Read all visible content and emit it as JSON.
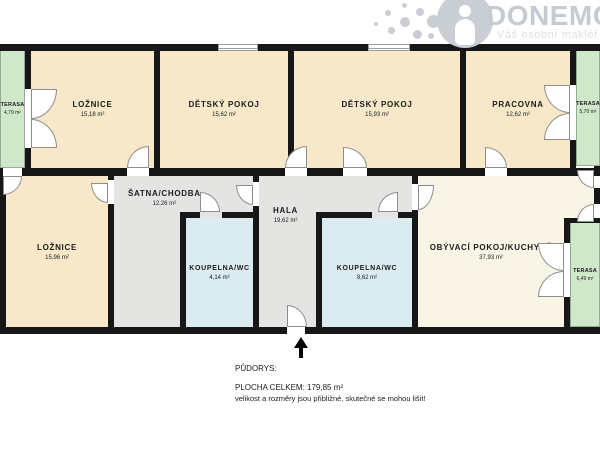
{
  "logo": {
    "brand": "DONEMO",
    "tagline": "Váš osobní makléř",
    "icon": "person-in-dotted-circle-logo",
    "color": "#c9ced4"
  },
  "rooms": [
    {
      "id": "terasa-top-left",
      "name": "TERASA",
      "area": "4,79 m²",
      "type": "terrace"
    },
    {
      "id": "loznice-top",
      "name": "LOŽNICE",
      "area": "15,18 m²",
      "type": "bedroom"
    },
    {
      "id": "detsky-pokoj-1",
      "name": "DĚTSKÝ POKOJ",
      "area": "15,62 m²",
      "type": "kids-room"
    },
    {
      "id": "detsky-pokoj-2",
      "name": "DĚTSKÝ POKOJ",
      "area": "15,93 m²",
      "type": "kids-room"
    },
    {
      "id": "pracovna",
      "name": "PRACOVNA",
      "area": "12,62 m²",
      "type": "office"
    },
    {
      "id": "terasa-top-right",
      "name": "TERASA",
      "area": "5,70 m²",
      "type": "terrace"
    },
    {
      "id": "loznice-bottom",
      "name": "LOŽNICE",
      "area": "15,96 m²",
      "type": "bedroom"
    },
    {
      "id": "satna-chodba",
      "name": "ŠATNA/CHODBA",
      "area": "12,26 m²",
      "type": "hallway"
    },
    {
      "id": "koupelna-1",
      "name": "KOUPELNA/WC",
      "area": "4,14 m²",
      "type": "bathroom"
    },
    {
      "id": "hala",
      "name": "HALA",
      "area": "19,62 m²",
      "type": "hall"
    },
    {
      "id": "koupelna-2",
      "name": "KOUPELNA/WC",
      "area": "8,62 m²",
      "type": "bathroom"
    },
    {
      "id": "obyvaci-pokoj",
      "name": "OBÝVACÍ POKOJ/KUCHYNĚ",
      "area": "37,93 m²",
      "type": "living-room-kitchen"
    },
    {
      "id": "terasa-bottom-right",
      "name": "TERASA",
      "area": "6,49 m²",
      "type": "terrace"
    }
  ],
  "footer": {
    "title": "PŮDORYS:",
    "total": "PLOCHA CELKEM:  179,85 m²",
    "disclaimer": "velikost a rozměry jsou přibližné, skutečné se mohou lišit!"
  },
  "colors": {
    "room_fill": "#f6e8c8",
    "living_fill": "#f8f4e6",
    "hall_fill": "#e4e4e2",
    "bath_fill": "#daebf2",
    "terrace_fill": "#cfe8ca",
    "wall": "#171717",
    "logo_gray": "#c9ced4"
  }
}
